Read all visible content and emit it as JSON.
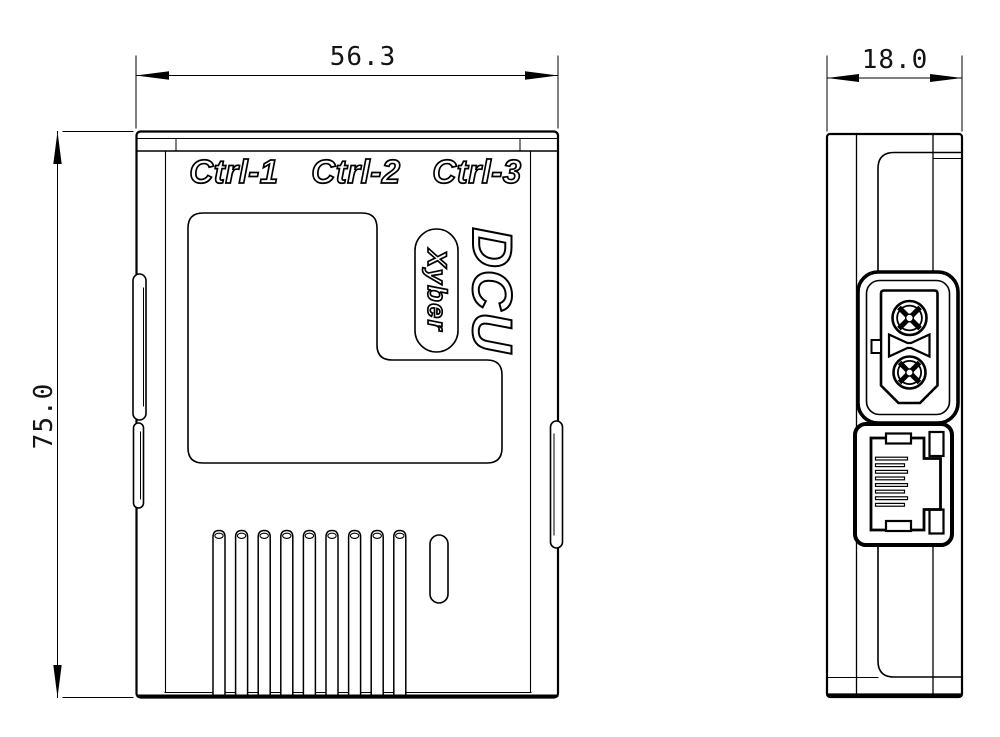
{
  "drawing": {
    "type": "2d-engineering-drawing",
    "units_implied": "mm",
    "line_color": "#000000",
    "background_color": "#ffffff",
    "dimensions": {
      "front_width": "56.3",
      "front_height": "75.0",
      "side_depth": "18.0"
    },
    "front_view": {
      "port_labels": [
        "Ctrl-1",
        "Ctrl-2",
        "Ctrl-3"
      ],
      "product_name": "DCU",
      "brand": "Xyber",
      "vent_slot_count": 9,
      "features": [
        "l-shaped-recess-panel",
        "vent-ribs",
        "small-slot",
        "side-mounting-clips"
      ]
    },
    "side_view": {
      "connectors": [
        "xt30-power-connector",
        "rj45-ethernet-port"
      ]
    }
  }
}
